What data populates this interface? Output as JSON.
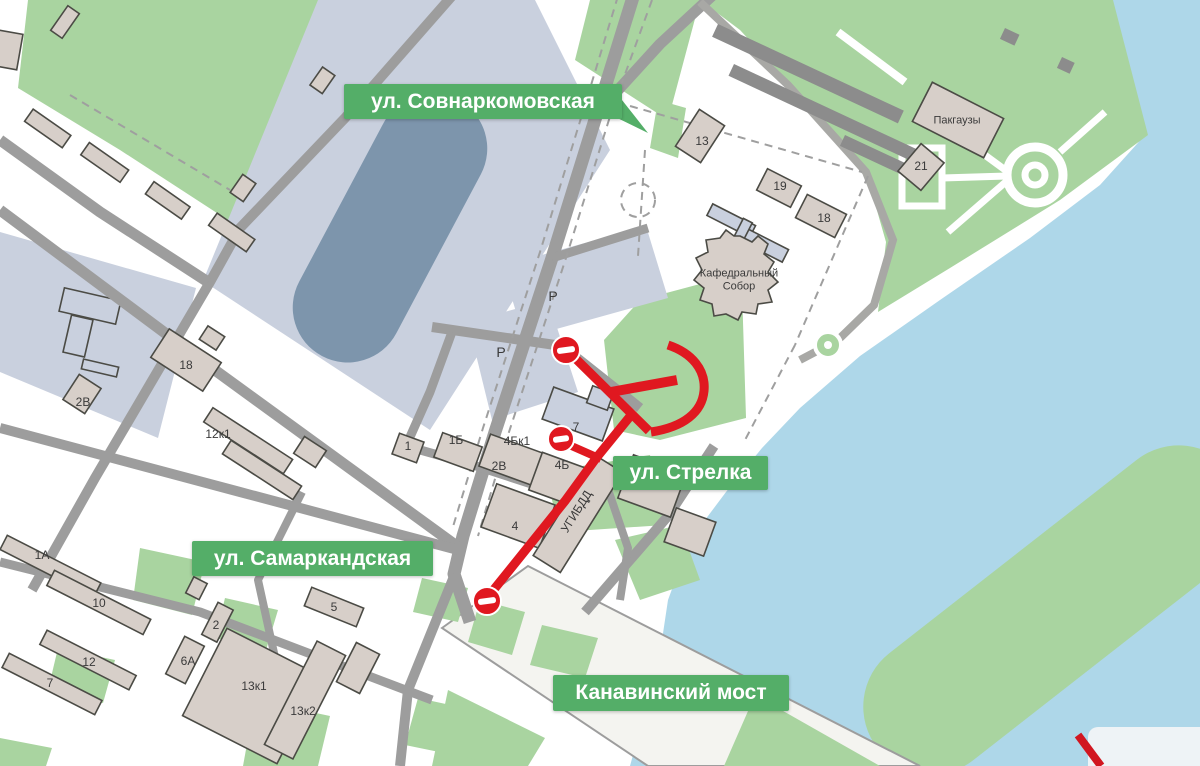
{
  "streets": {
    "sovnarkomovskaya": {
      "label": "ул. Совнаркомовская"
    },
    "strelka": {
      "label": "ул. Стрелка"
    },
    "samarkandskaya": {
      "label": "ул. Самаркандская"
    },
    "kanavinsky_bridge": {
      "label": "Канавинский мост"
    }
  },
  "map_labels": [
    {
      "text": "18",
      "x": 186,
      "y": 366
    },
    {
      "text": "2В",
      "x": 83,
      "y": 403
    },
    {
      "text": "12к1",
      "x": 218,
      "y": 435
    },
    {
      "text": "1А",
      "x": 42,
      "y": 556
    },
    {
      "text": "10",
      "x": 99,
      "y": 604
    },
    {
      "text": "12",
      "x": 89,
      "y": 663
    },
    {
      "text": "7",
      "x": 50,
      "y": 684
    },
    {
      "text": "2",
      "x": 216,
      "y": 626
    },
    {
      "text": "6А",
      "x": 188,
      "y": 662
    },
    {
      "text": "13к1",
      "x": 254,
      "y": 687
    },
    {
      "text": "13к2",
      "x": 303,
      "y": 712
    },
    {
      "text": "5",
      "x": 334,
      "y": 608
    },
    {
      "text": "1",
      "x": 408,
      "y": 447
    },
    {
      "text": "1Б",
      "x": 456,
      "y": 441
    },
    {
      "text": "4Бк1",
      "x": 517,
      "y": 442
    },
    {
      "text": "2В",
      "x": 499,
      "y": 467
    },
    {
      "text": "4Б",
      "x": 562,
      "y": 466
    },
    {
      "text": "7",
      "x": 576,
      "y": 428
    },
    {
      "text": "4",
      "x": 515,
      "y": 527
    },
    {
      "text": "13",
      "x": 702,
      "y": 142
    },
    {
      "text": "19",
      "x": 780,
      "y": 187
    },
    {
      "text": "18",
      "x": 824,
      "y": 219
    },
    {
      "text": "21",
      "x": 921,
      "y": 167
    },
    {
      "text": "Пакгаузы",
      "x": 957,
      "y": 121,
      "size": 11
    },
    {
      "text": "P",
      "x": 553,
      "y": 296,
      "size": 14
    },
    {
      "text": "P",
      "x": 501,
      "y": 352,
      "size": 14
    },
    {
      "text": "УГИБДД",
      "x": 577,
      "y": 512,
      "size": 12,
      "rot": -58
    },
    {
      "text": "Кафедральный\nСобор",
      "x": 739,
      "y": 280,
      "size": 11
    }
  ],
  "road_closure_signs": 3,
  "colors": {
    "water": "#aed7e9",
    "park": "#a9d4a0",
    "badge": "#54ae68",
    "road": "#9d9d9d",
    "building": "#d7cfc9",
    "blueblock": "#c9d0de",
    "oval": "#7d95ac",
    "darkbar": "#8c8c8c",
    "red": "#e01820"
  }
}
